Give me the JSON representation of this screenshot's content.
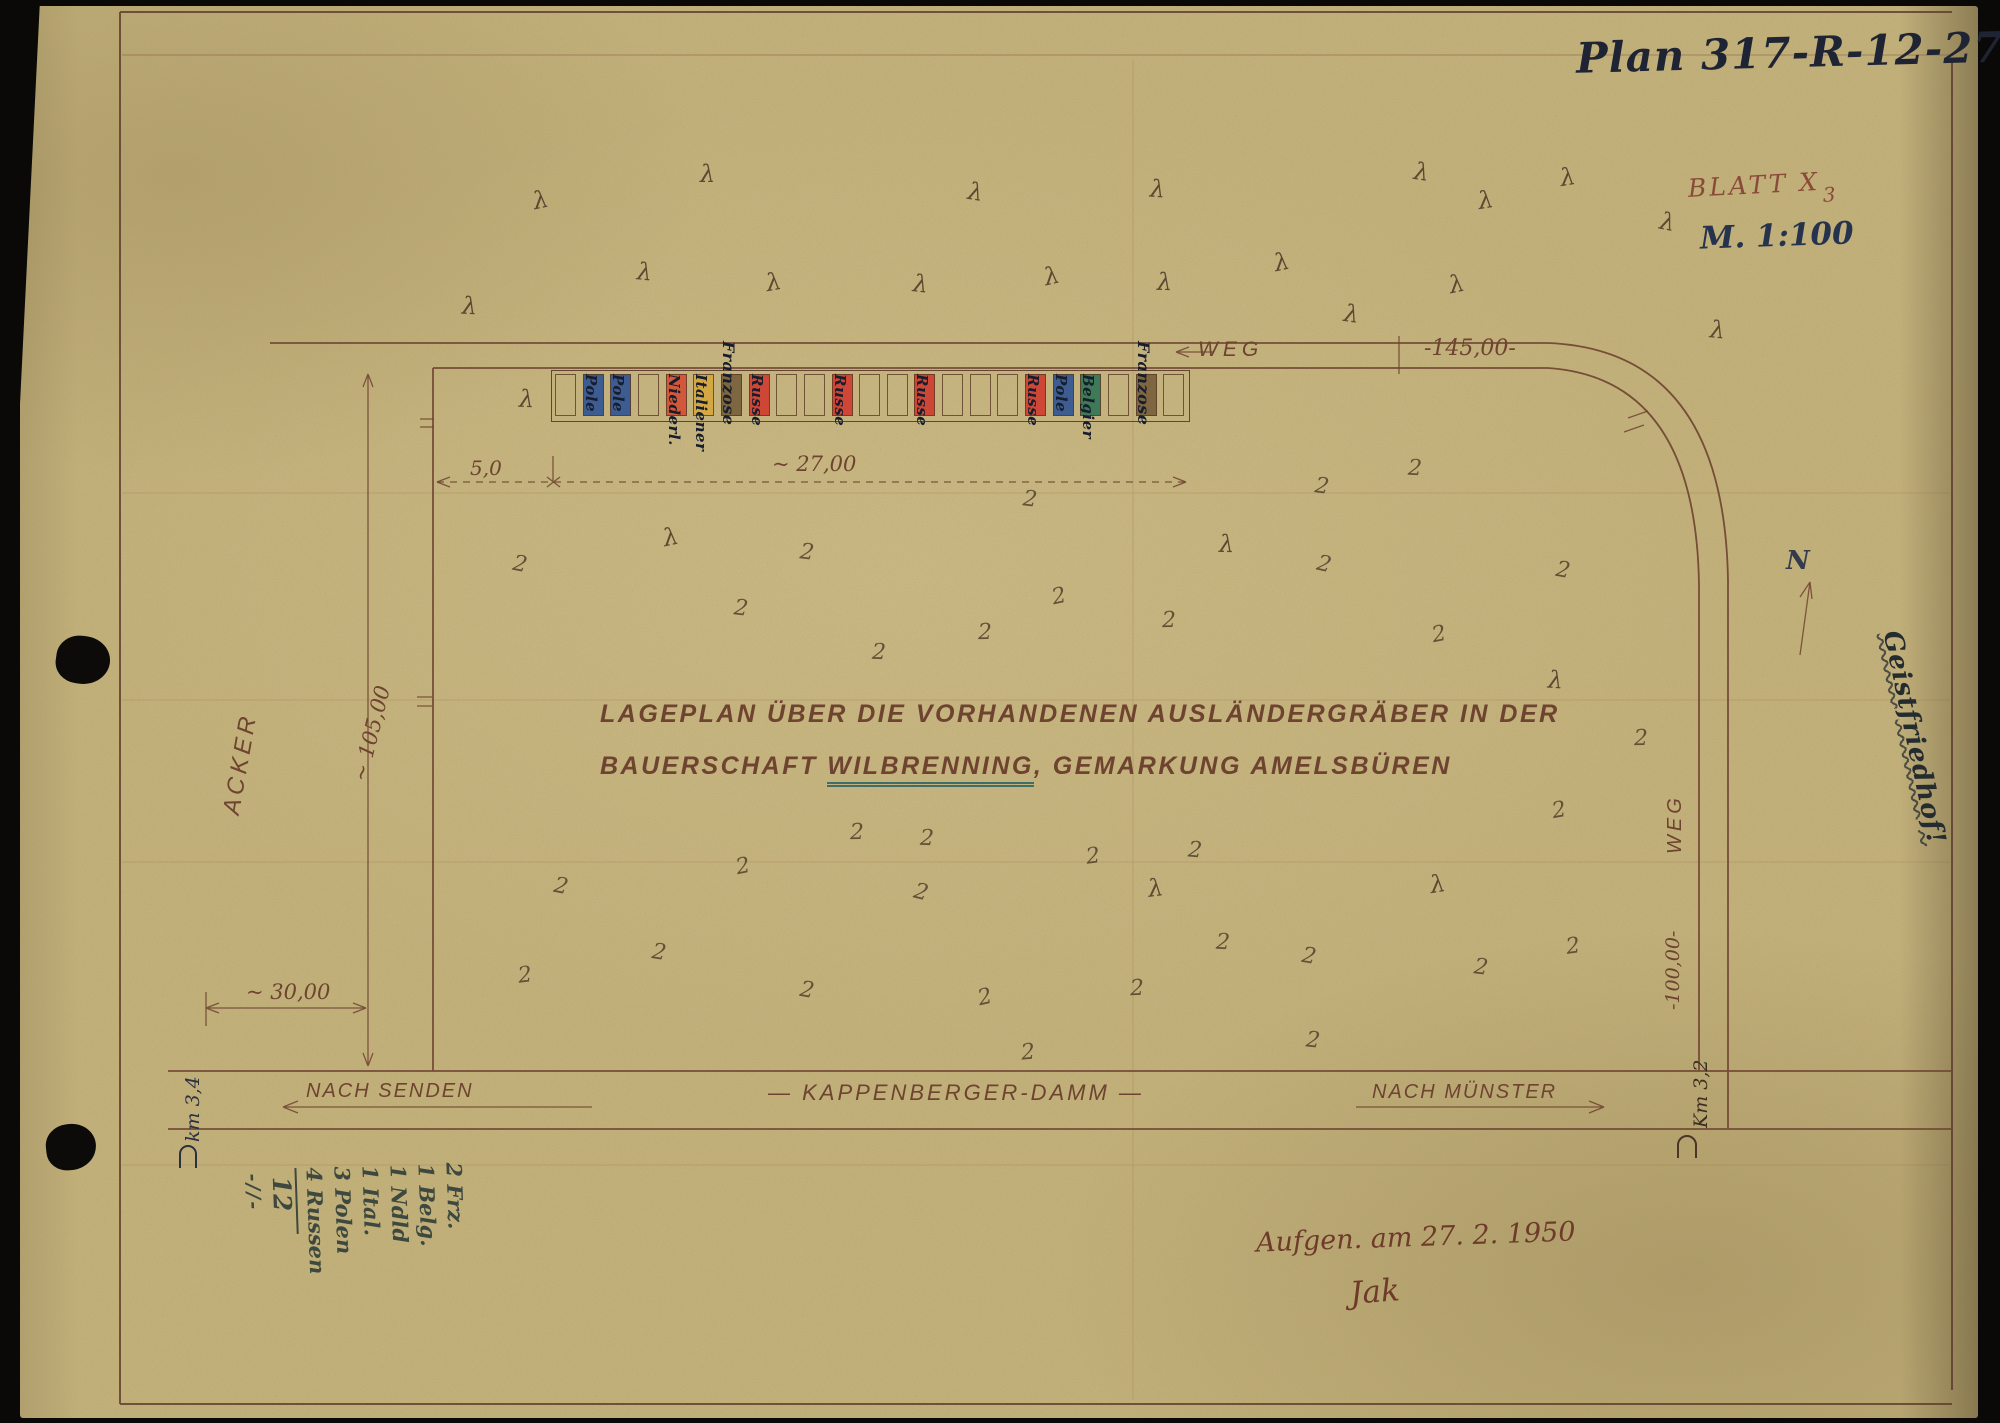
{
  "page": {
    "plan_number": "Plan 317-R-12-27.",
    "blatt": "BLATT X",
    "blatt_index": "3",
    "scale": "M. 1:100",
    "margin_note": "Geistfriedhof!",
    "survey": "Aufgen. am 27. 2. 1950",
    "signature": "Jak",
    "north": "N"
  },
  "title": {
    "line1": "LAGEPLAN ÜBER DIE VORHANDENEN AUSLÄNDERGRÄBER IN DER",
    "line2_pre": "BAUERSCHAFT ",
    "line2_u": "WILBRENNING",
    "line2_post": ", GEMARKUNG AMELSBÜREN"
  },
  "roads": {
    "top_label": "WEG",
    "top_dim": "-145,00-",
    "right_label": "WEG",
    "right_dim": "-100,00-",
    "bottom_label": "— KAPPENBERGER-DAMM —",
    "dir_left": "NACH SENDEN",
    "dir_right": "NACH MÜNSTER",
    "km_left": "km 3,4",
    "km_right": "Km 3,2"
  },
  "dims": {
    "offset": "5,0",
    "row": "~ 27,00",
    "depth": "~ 105,00",
    "left": "~ 30,00"
  },
  "field": {
    "acker": "ACKER"
  },
  "graves": {
    "cells": [
      {
        "c": "",
        "l": ""
      },
      {
        "c": "blue",
        "l": "Pole"
      },
      {
        "c": "blue",
        "l": "Pole"
      },
      {
        "c": "",
        "l": ""
      },
      {
        "c": "orange",
        "l": "Niederl."
      },
      {
        "c": "yellow",
        "l": "Italiener"
      },
      {
        "c": "brown",
        "l": "Franzose"
      },
      {
        "c": "red",
        "l": "Russe"
      },
      {
        "c": "",
        "l": ""
      },
      {
        "c": "",
        "l": ""
      },
      {
        "c": "red",
        "l": "Russe"
      },
      {
        "c": "",
        "l": ""
      },
      {
        "c": "",
        "l": ""
      },
      {
        "c": "red",
        "l": "Russe"
      },
      {
        "c": "",
        "l": ""
      },
      {
        "c": "",
        "l": ""
      },
      {
        "c": "",
        "l": ""
      },
      {
        "c": "red",
        "l": "Russe"
      },
      {
        "c": "blue",
        "l": "Pole"
      },
      {
        "c": "green",
        "l": "Belgier"
      },
      {
        "c": "",
        "l": ""
      },
      {
        "c": "brown",
        "l": "Franzose"
      },
      {
        "c": "",
        "l": ""
      }
    ]
  },
  "tally": {
    "entries": [
      "2 Frz.",
      "1 Belg.",
      "1 Ndld",
      "1 Ital.",
      "3 Polen",
      "4 Russen"
    ],
    "total": "12",
    "flourish": "-//-"
  },
  "marks": [
    [
      462,
      292,
      "λ"
    ],
    [
      533,
      186,
      "λ"
    ],
    [
      637,
      258,
      "λ"
    ],
    [
      700,
      160,
      "λ"
    ],
    [
      766,
      268,
      "λ"
    ],
    [
      913,
      270,
      "λ"
    ],
    [
      968,
      178,
      "λ"
    ],
    [
      1044,
      262,
      "λ"
    ],
    [
      1150,
      175,
      "λ"
    ],
    [
      1157,
      268,
      "λ"
    ],
    [
      1274,
      248,
      "λ"
    ],
    [
      1344,
      300,
      "λ"
    ],
    [
      1414,
      158,
      "λ"
    ],
    [
      1449,
      270,
      "λ"
    ],
    [
      1478,
      186,
      "λ"
    ],
    [
      1560,
      163,
      "λ"
    ],
    [
      1660,
      208,
      "λ"
    ],
    [
      1710,
      316,
      "λ"
    ],
    [
      519,
      385,
      "λ"
    ],
    [
      663,
      523,
      "λ"
    ],
    [
      1219,
      530,
      "λ"
    ],
    [
      1548,
      666,
      "λ"
    ],
    [
      1430,
      870,
      "λ"
    ],
    [
      1148,
      874,
      "λ"
    ],
    [
      513,
      552,
      "2"
    ],
    [
      734,
      596,
      "2"
    ],
    [
      800,
      540,
      "2"
    ],
    [
      1023,
      487,
      "2"
    ],
    [
      1052,
      584,
      "2"
    ],
    [
      1162,
      608,
      "2"
    ],
    [
      872,
      640,
      "2"
    ],
    [
      978,
      620,
      "2"
    ],
    [
      1315,
      474,
      "2"
    ],
    [
      1408,
      456,
      "2"
    ],
    [
      1317,
      552,
      "2"
    ],
    [
      1432,
      622,
      "2"
    ],
    [
      1556,
      558,
      "2"
    ],
    [
      850,
      820,
      "2"
    ],
    [
      920,
      826,
      "2"
    ],
    [
      554,
      874,
      "2"
    ],
    [
      736,
      854,
      "2"
    ],
    [
      914,
      880,
      "2"
    ],
    [
      1086,
      844,
      "2"
    ],
    [
      1188,
      838,
      "2"
    ],
    [
      518,
      963,
      "2"
    ],
    [
      652,
      940,
      "2"
    ],
    [
      800,
      978,
      "2"
    ],
    [
      978,
      985,
      "2"
    ],
    [
      1130,
      976,
      "2"
    ],
    [
      1302,
      944,
      "2"
    ],
    [
      1474,
      955,
      "2"
    ],
    [
      1566,
      934,
      "2"
    ],
    [
      1306,
      1028,
      "2"
    ],
    [
      1634,
      726,
      "2"
    ],
    [
      1552,
      798,
      "2"
    ],
    [
      1021,
      1040,
      "2"
    ],
    [
      1216,
      930,
      "2"
    ]
  ],
  "colors": {
    "paper": "#c2b07a",
    "ink_dark": "#1e2433",
    "ink_draw": "#6e4330",
    "ink_red": "#8a4a38",
    "pencil": "#3d483e",
    "grave_blue": "#3d5c92",
    "grave_red": "#cd4636",
    "grave_orange": "#d1583a",
    "grave_yellow": "#d3a843",
    "grave_green": "#3e7a58",
    "grave_brown": "#7d6640"
  }
}
